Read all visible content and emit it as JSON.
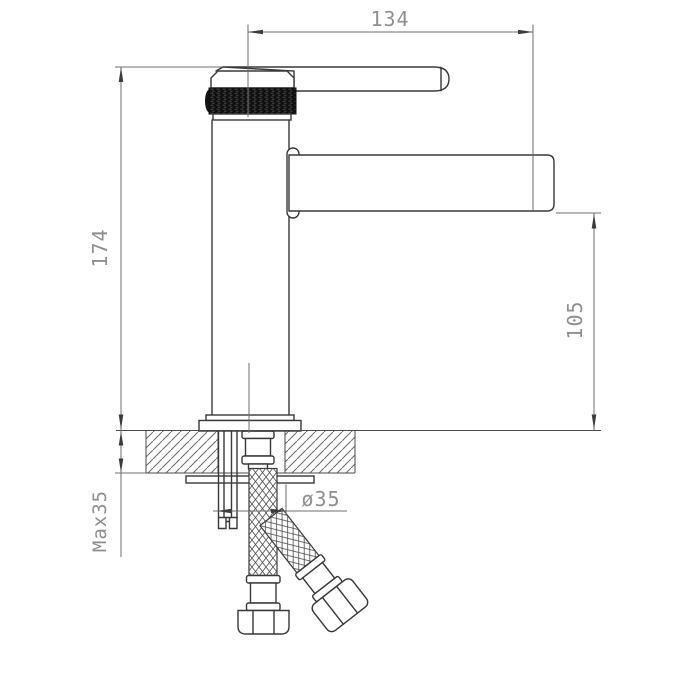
{
  "drawing": {
    "subject": "single-lever basin faucet side elevation with installation dimensions",
    "dimensions": {
      "spout_reach": "134",
      "total_height": "174",
      "spout_height": "105",
      "max_counter_thickness": "Max35",
      "hole_diameter": "ø35"
    },
    "colors": {
      "object_line": "#383838",
      "dimension_line": "#6e6e6e",
      "label_text": "#8f8f8f",
      "knurl_fill": "#101010",
      "background": "#ffffff"
    }
  }
}
